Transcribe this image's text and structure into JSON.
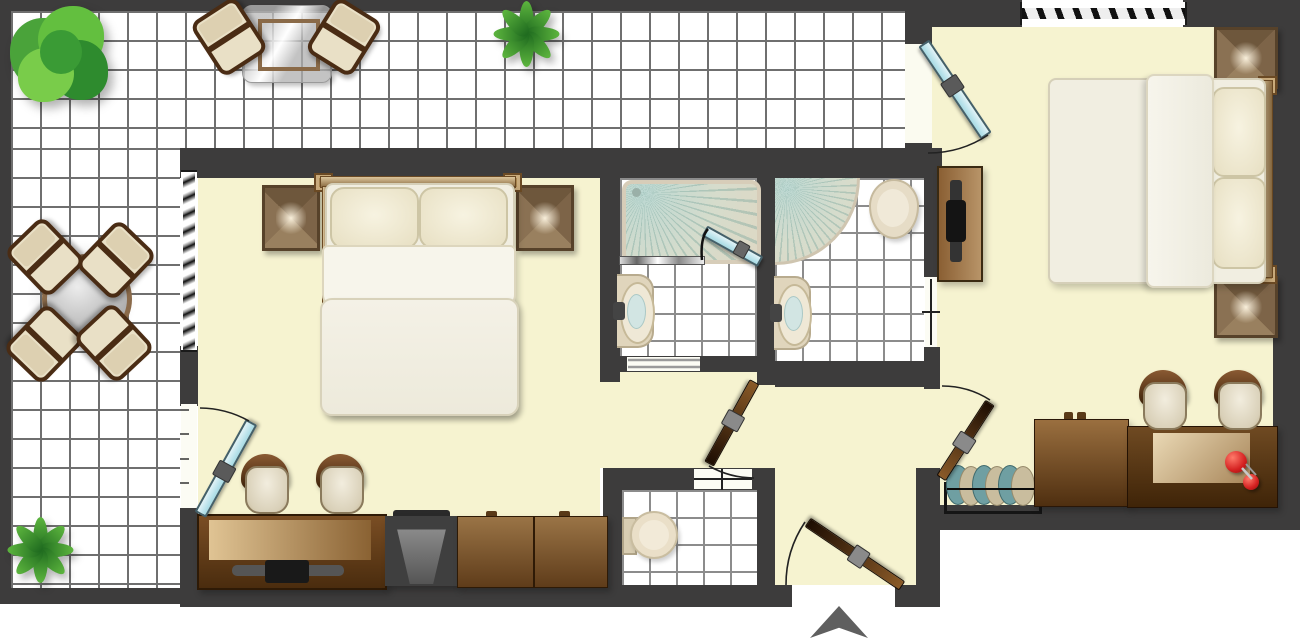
{
  "meta": {
    "type": "floor-plan",
    "description": "Top-down architectural floor plan of an apartment: L-shaped tiled terrace on the left/top, left bedroom, two shower rooms, WC, entrance hall and right bedroom",
    "canvas": {
      "width": 1300,
      "height": 644
    }
  },
  "palette": {
    "wall": "#3d3c3c",
    "room_floor": "#f6f3d0",
    "tile_floor": "#ffffff",
    "tile_line_outdoor": "#6f6f6f",
    "tile_line_bath": "#8c8c8c",
    "glazed_door": "#b9e4ec",
    "wood_door": "#5a3415",
    "wood_furniture": "#8a6a42",
    "bedding_cream": "#f1eee1",
    "upholstery": "#e9e0c6",
    "shower_fan": "#bcd8d2",
    "plant_green": "#4aa33a",
    "accent_red": "#d42020",
    "entrance_marker": "#5f5f5f"
  },
  "areas": {
    "terrace": {
      "name": "terrace",
      "floor": "outdoor tile grid",
      "items": [
        "round shrub",
        "fern plant north",
        "fern plant south-west",
        "square glass table with 2 patio chairs",
        "round glass table with 4 patio chairs"
      ]
    },
    "bedroom_left": {
      "name": "left bedroom",
      "floor": "cream",
      "items": [
        "double bed with 2 pillows",
        "2 bedside tables",
        "2 desk chairs",
        "desk with media console",
        "dark tv seat unit",
        "2-door low cabinet"
      ],
      "windows": [
        "west wall blind window"
      ],
      "doors": [
        "glazed terrace door (west)",
        "open passage to hall (east)"
      ]
    },
    "shower_room_1": {
      "name": "shower room 1",
      "floor": "bath tile grid",
      "items": [
        "rectangular shower tray with glass screen and glazed swing panel",
        "wall-hung wash basin"
      ],
      "doors": [
        "sliding threshold to hall"
      ]
    },
    "shower_room_2": {
      "name": "shower room 2",
      "floor": "bath tile grid",
      "items": [
        "quarter-circle corner shower",
        "toilet",
        "wall-hung wash basin"
      ],
      "doors": [
        "sliding door to right bedroom"
      ]
    },
    "wc": {
      "name": "guest wc",
      "floor": "bath tile grid",
      "items": [
        "toilet with cistern"
      ],
      "doors": [
        "hinged door to hall (drawn closed)"
      ]
    },
    "hall": {
      "name": "entrance hall",
      "floor": "cream",
      "items": [],
      "doors": [
        "wood door to bath lobby",
        "wood entrance door (south)",
        "wood door to right bedroom"
      ]
    },
    "bedroom_right": {
      "name": "right bedroom",
      "floor": "cream",
      "items": [
        "double bed (headboard east) with 2 pillows",
        "2 bedside tables",
        "tv cabinet with flat tv",
        "sectional radiator",
        "dresser",
        "desk with writing mat and red desk object",
        "2 desk chairs"
      ],
      "windows": [
        "north wall blind window"
      ],
      "doors": [
        "glazed terrace door (north-west)",
        "wood door from hall (south-west)"
      ]
    }
  },
  "doors": [
    {
      "id": "left-bedroom-terrace-door",
      "type": "glazed",
      "color": "#b9e4ec"
    },
    {
      "id": "right-bedroom-terrace-door",
      "type": "glazed",
      "color": "#b9e4ec"
    },
    {
      "id": "shower-swing-panel",
      "type": "glazed",
      "color": "#b9e4ec"
    },
    {
      "id": "bath-lobby-door",
      "type": "wood",
      "color": "#5a3415"
    },
    {
      "id": "right-bedroom-hall-door",
      "type": "wood",
      "color": "#5a3415"
    },
    {
      "id": "entrance-door",
      "type": "wood",
      "color": "#5a3415"
    }
  ],
  "windows": [
    {
      "id": "left-bedroom-window",
      "wall": "west"
    },
    {
      "id": "right-bedroom-window",
      "wall": "north"
    }
  ],
  "entrance": {
    "marker": "upward arrow below entrance gap",
    "color": "#5f5f5f"
  }
}
